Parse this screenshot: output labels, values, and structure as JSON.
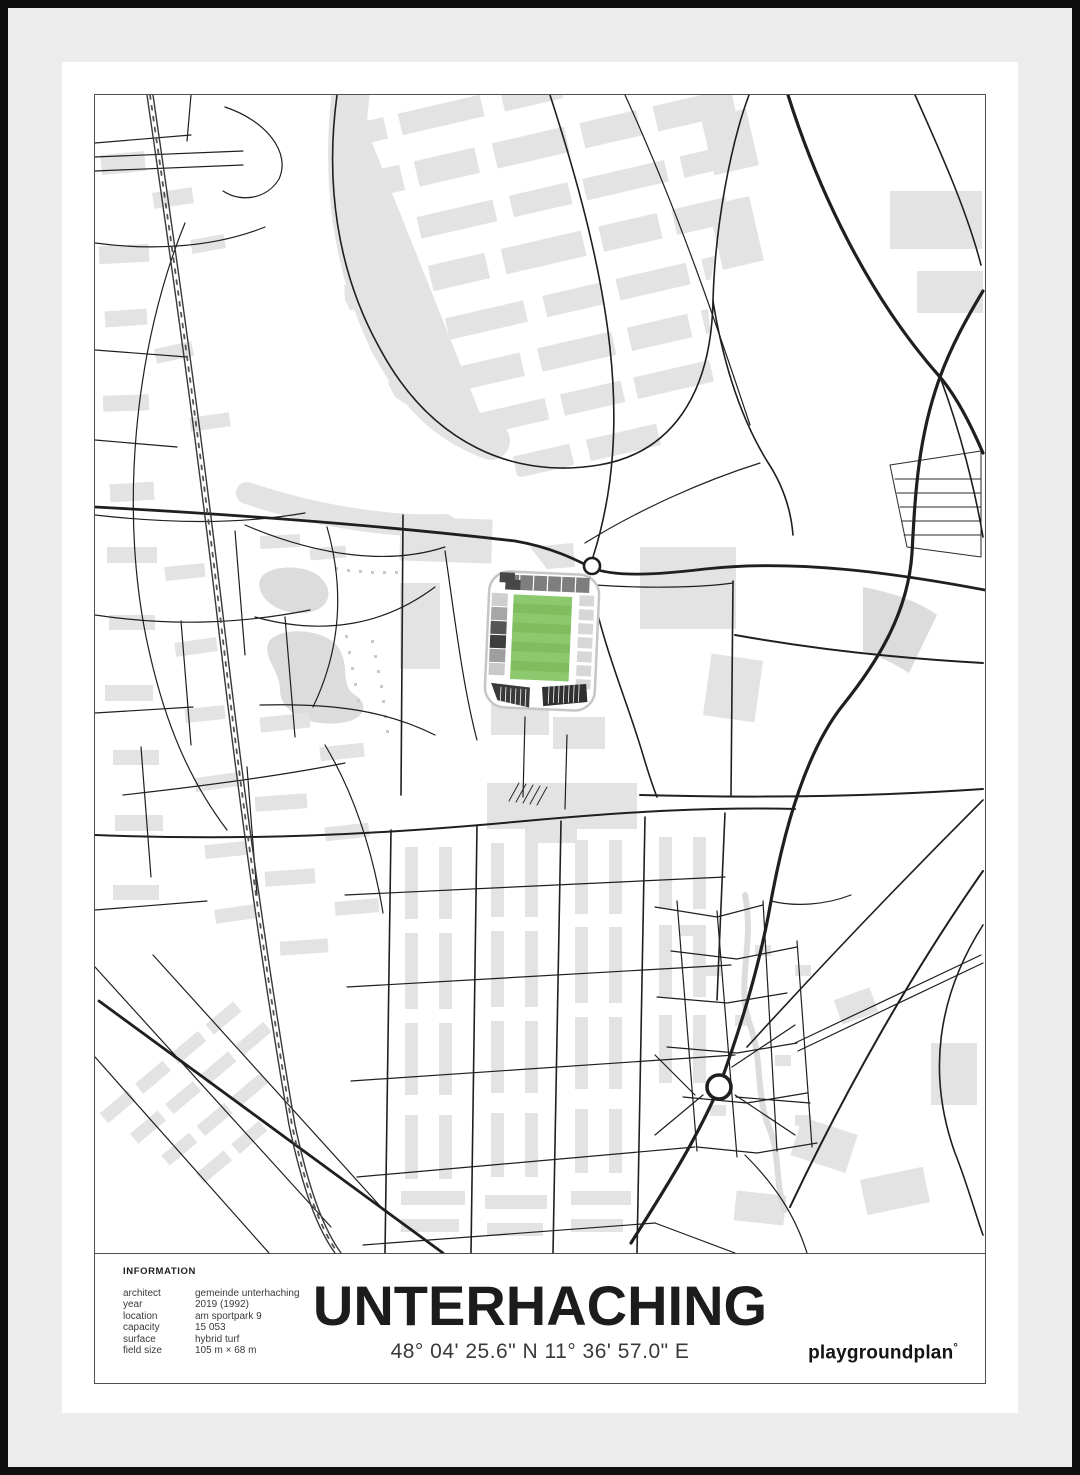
{
  "poster": {
    "title": "UNTERHACHING",
    "coordinates": "48° 04' 25.6\" N 11° 36' 57.0\" E",
    "brand": "playgroundplan",
    "brand_mark": "°",
    "info": {
      "heading": "INFORMATION",
      "rows": [
        {
          "label": "architect",
          "value": "gemeinde unterhaching"
        },
        {
          "label": "year",
          "value": "2019 (1992)"
        },
        {
          "label": "location",
          "value": "am sportpark 9"
        },
        {
          "label": "capacity",
          "value": "15 053"
        },
        {
          "label": "surface",
          "value": "hybrid turf"
        },
        {
          "label": "field size",
          "value": "105 m × 68 m"
        }
      ]
    }
  },
  "map": {
    "landmark": "stadium-with-green-pitch",
    "features": [
      "streets",
      "railway",
      "roundabout",
      "stadium",
      "buildings",
      "stream",
      "allotment-field",
      "ponds"
    ],
    "colors": {
      "pitch_green_light": "#8CC96E",
      "pitch_green_dark": "#7FBD5E",
      "building_gray": "#E3E3E3",
      "street_black": "#1F1F1F",
      "stand_dark": "#3E3E3E",
      "stand_light": "#D7D7D7",
      "stream_gray": "#DCDCDC",
      "mat_gray": "#ECECEC",
      "frame_black": "#0F0F0F"
    }
  }
}
